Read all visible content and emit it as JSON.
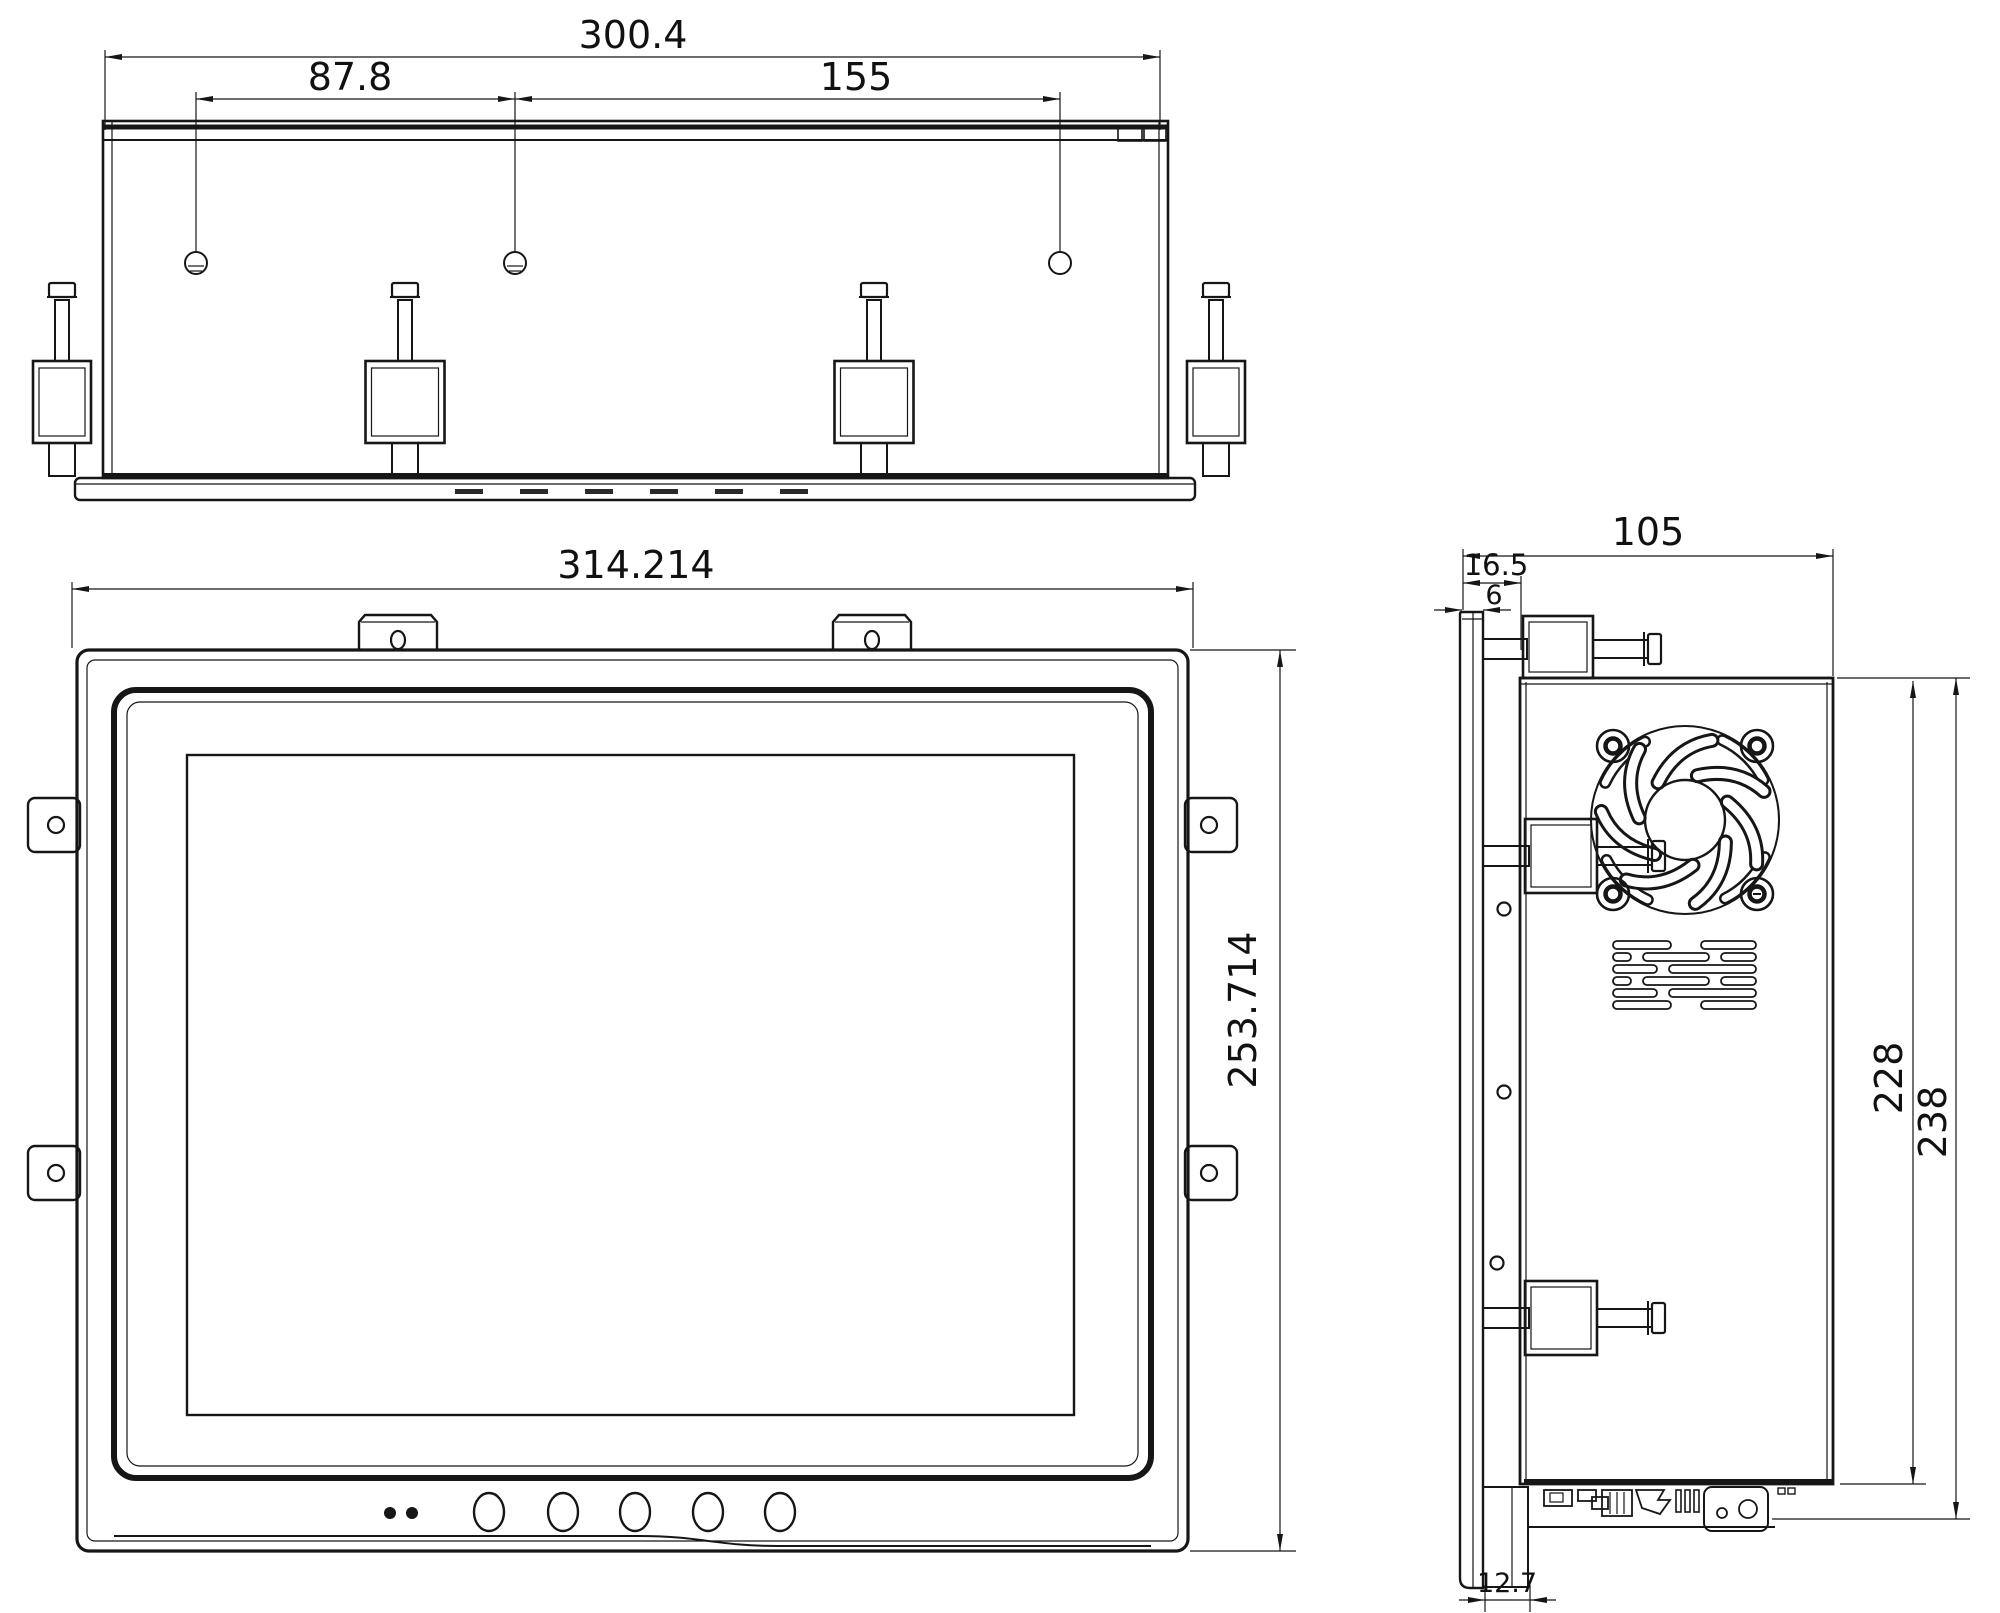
{
  "dims": {
    "top_overall": "300.4",
    "top_span_left": "87.8",
    "top_span_right": "155",
    "front_width": "314.214",
    "front_height": "253.714",
    "side_depth": "105",
    "side_front_clearance": "16.5",
    "side_bezel_thickness": "6",
    "side_chassis_height": "228",
    "side_overall_height": "238",
    "side_foot_offset": "12.7"
  }
}
